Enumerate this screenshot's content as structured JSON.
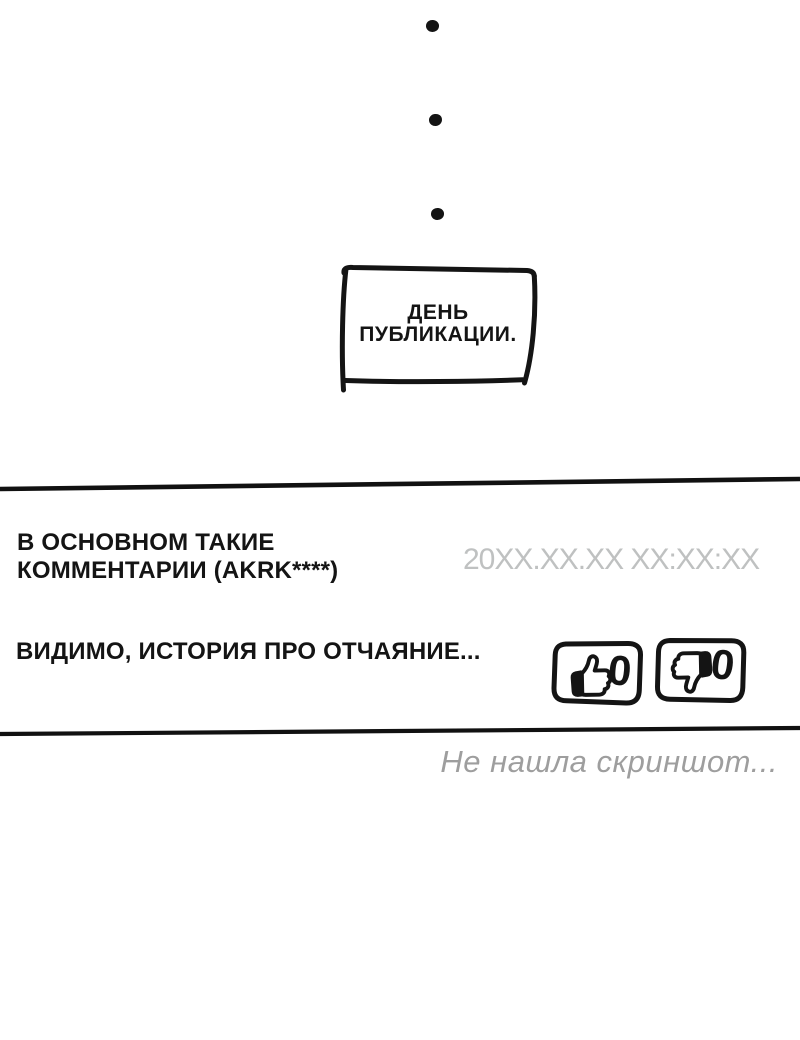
{
  "colors": {
    "ink": "#141414",
    "timestamp_gray": "#bfc1c1",
    "note_gray": "#9e9e9e",
    "background": "#ffffff"
  },
  "ellipsis": {
    "dot_count": 3
  },
  "speech_box": {
    "line1": "ДЕНЬ",
    "line2": "ПУБЛИКАЦИИ."
  },
  "comment": {
    "header_line1": "В ОСНОВНОМ ТАКИЕ",
    "header_line2": "КОММЕНТАРИИ (AKRK****)",
    "timestamp": "20XX.XX.XX XX:XX:XX",
    "body": "ВИДИМО, ИСТОРИЯ ПРО ОТЧАЯНИЕ...",
    "like_count": "0",
    "dislike_count": "0"
  },
  "footer": {
    "note": "Не нашла скриншот..."
  }
}
